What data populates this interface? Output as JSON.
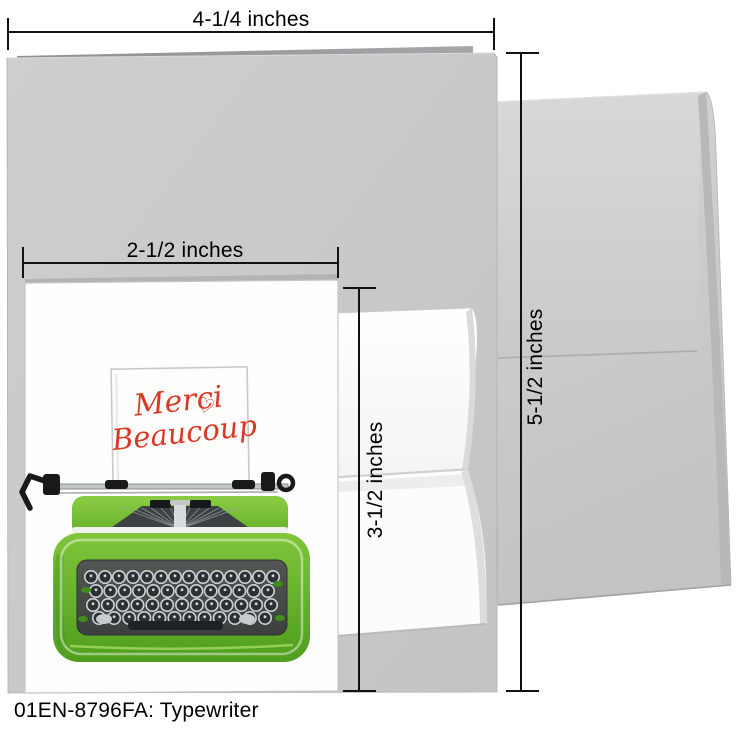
{
  "caption": "01EN-8796FA: Typewriter",
  "dimension_labels": {
    "card_width": "4-1/4 inches",
    "card_height": "5-1/2 inches",
    "design_width": "2-1/2 inches",
    "design_height": "3-1/2 inches"
  },
  "note_card": {
    "greeting_line1": "Merci",
    "greeting_line2": "Beaucoup",
    "heart_icon": "♡"
  },
  "colors": {
    "greeting_red": "#da3827",
    "typewriter_green": "#6cbb2a",
    "card_gray": "#c9cacc",
    "envelope_gray": "#cdced0",
    "dimension_black": "#111111"
  }
}
